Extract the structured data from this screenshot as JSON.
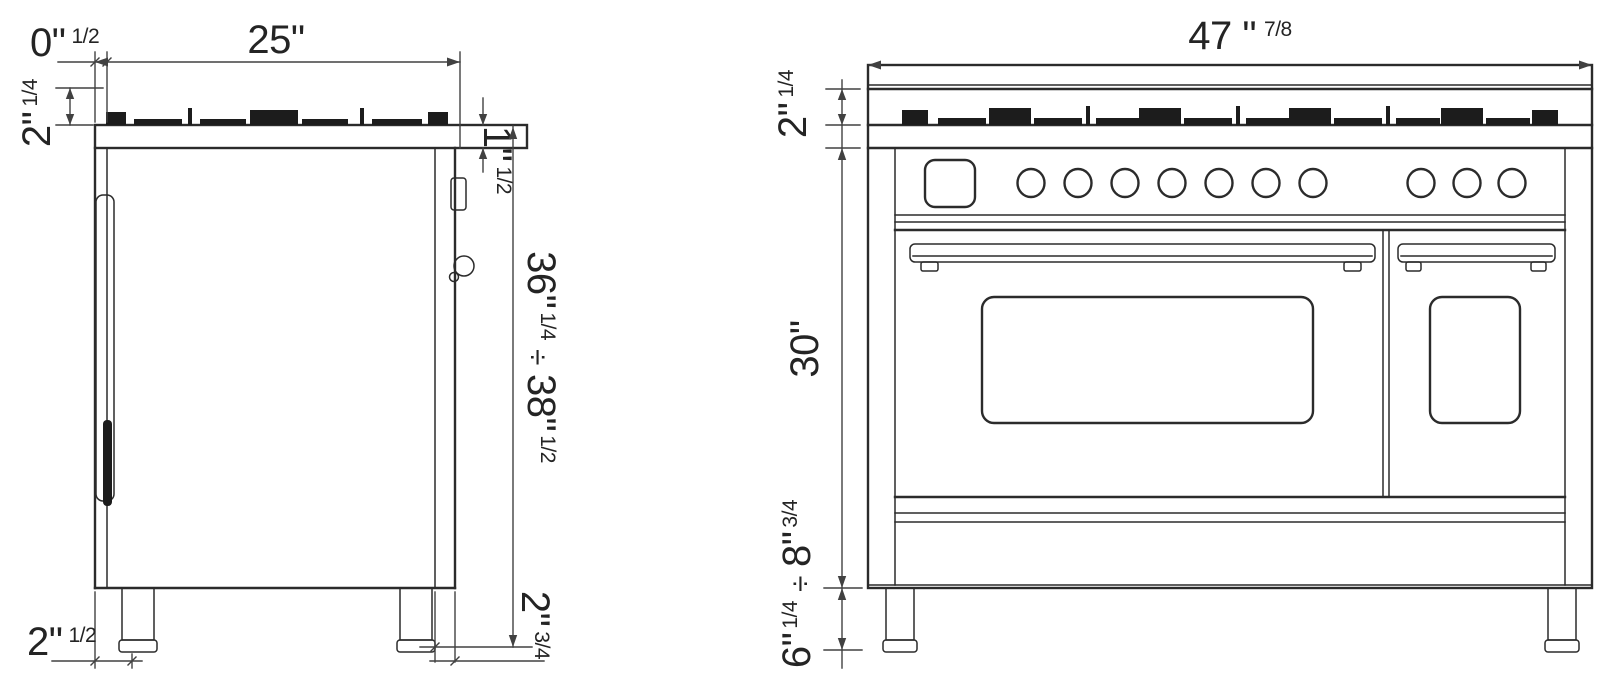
{
  "diagram": {
    "background": "#ffffff",
    "line_color": "#2b2b2b",
    "dimension_line_color": "#414141",
    "text_color": "#242424",
    "side_view": {
      "dim_front_offset": {
        "main": "0\"",
        "frac": "1/2"
      },
      "dim_depth": {
        "main": "25\"",
        "frac": ""
      },
      "dim_grate_height": {
        "main": "2\"",
        "frac": "1/4"
      },
      "dim_top_lip": {
        "main": "1\"",
        "frac": "1/2"
      },
      "dim_height_range": {
        "min_main": "36\"",
        "min_frac": "1/4",
        "separator": "÷",
        "max_main": "38\"",
        "max_frac": "1/2"
      },
      "dim_bottom_front": {
        "main": "2\"",
        "frac": "1/2"
      },
      "dim_bottom_rear": {
        "main": "2\"",
        "frac": "3/4"
      }
    },
    "front_view": {
      "dim_width": {
        "main": "47 \"",
        "frac": "7/8"
      },
      "dim_grate_height": {
        "main": "2\"",
        "frac": "1/4"
      },
      "dim_body_height": {
        "main": "30\"",
        "frac": ""
      },
      "dim_leg_range": {
        "min_main": "6\"",
        "min_frac": "1/4",
        "separator": "÷",
        "max_main": "8\"",
        "max_frac": "3/4"
      }
    }
  }
}
